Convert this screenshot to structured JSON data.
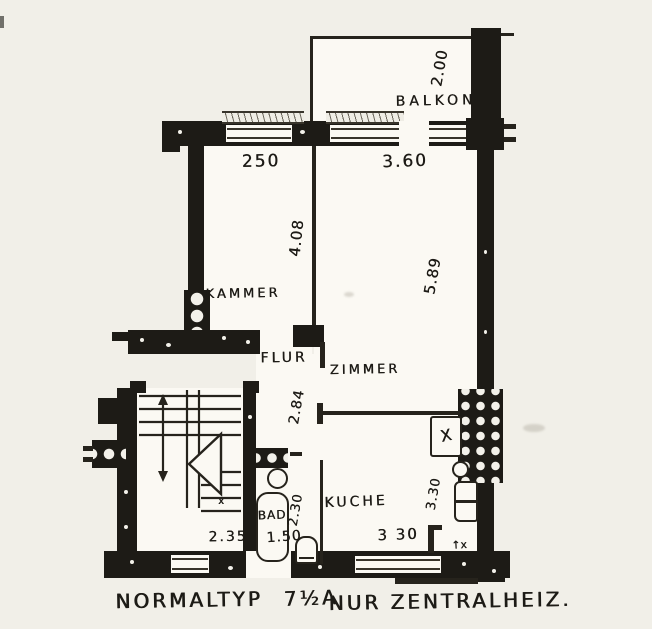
{
  "plan": {
    "rooms": {
      "balkon": "BALKON",
      "kammer": "KAMMER",
      "flur": "FLUR",
      "zimmer": "ZIMMER",
      "kueche": "KUCHE",
      "bad": "BAD"
    },
    "dimensions": {
      "balkon_depth": "2.00",
      "balkon_width": "3.60",
      "kammer_width": "250",
      "kammer_length": "4.08",
      "zimmer_length": "5.89",
      "flur_length": "2.84",
      "bad_length": "2.30",
      "bad_width": "1.50",
      "stairroom_width": "2.35",
      "kueche_depth": "3.30",
      "kueche_width": "3 30"
    },
    "symbols": {
      "stove": "X",
      "vent": "↑x",
      "stair_direction": "x"
    },
    "colors": {
      "ink": "#1d1b16",
      "paper": "#f1efe8",
      "room_fill": "#fbf9f3"
    }
  },
  "caption": {
    "type_label": "NORMALTYP",
    "type_code": "7½A",
    "note": "NUR ZENTRALHEIZ."
  }
}
